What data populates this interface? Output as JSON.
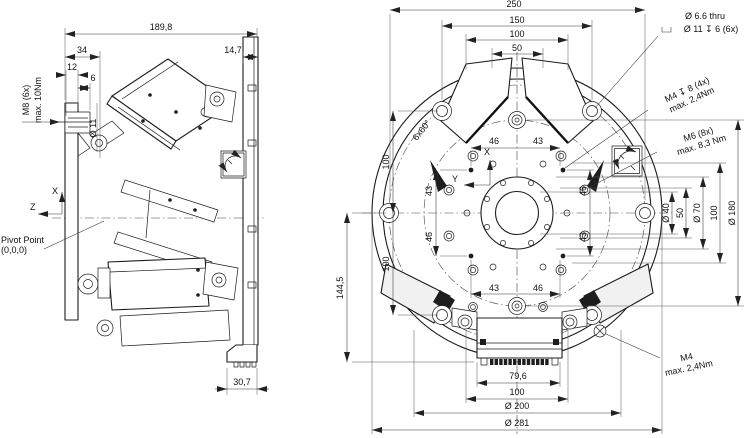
{
  "drawing": {
    "side_view": {
      "d189_8": "189,8",
      "d34": "34",
      "d14_7": "14,7",
      "d12": "12",
      "d6": "6",
      "dia11": "Ø 11",
      "m8_line1": "M8 (6x)",
      "m8_line2": "max. 10Nm",
      "d30_7": "30,7",
      "pivot_line1": "Pivot Point",
      "pivot_line2": "(0,0,0)",
      "axis_x": "X",
      "axis_z": "Z"
    },
    "front_view": {
      "top": {
        "d250": "250",
        "d150": "150",
        "d100": "100",
        "d50": "50"
      },
      "left": {
        "d100_upper": "100",
        "d100_lower": "100",
        "d144_5": "144,5"
      },
      "right": {
        "dia40": "Ø 40",
        "d50": "50",
        "dia70": "Ø 70",
        "d100": "100",
        "dia180": "Ø 180"
      },
      "bottom": {
        "d79_6": "79,6",
        "d100": "100",
        "dia200": "Ø 200",
        "dia281": "Ø 281"
      },
      "inner": {
        "top_46": "46",
        "top_43": "43",
        "left_43": "43",
        "left_46": "46",
        "right_46": "46",
        "right_43": "43",
        "bottom_43": "43",
        "bottom_46": "46"
      },
      "angle_note": "6x60°",
      "cbore_line1": "Ø 6.6 thru",
      "cbore_line2": "Ø 11 ↧ 6 (6x)",
      "m4_tapped_line1": "M4 ↧ 8 (4x)",
      "m4_tapped_line2": "max. 2,4Nm",
      "m6_line1": "M6 (8x)",
      "m6_line2": "max. 8,3 Nm",
      "m4_ground_line1": "M4",
      "m4_ground_line2": "max. 2,4Nm",
      "axis_x": "X",
      "axis_y": "Y"
    }
  }
}
